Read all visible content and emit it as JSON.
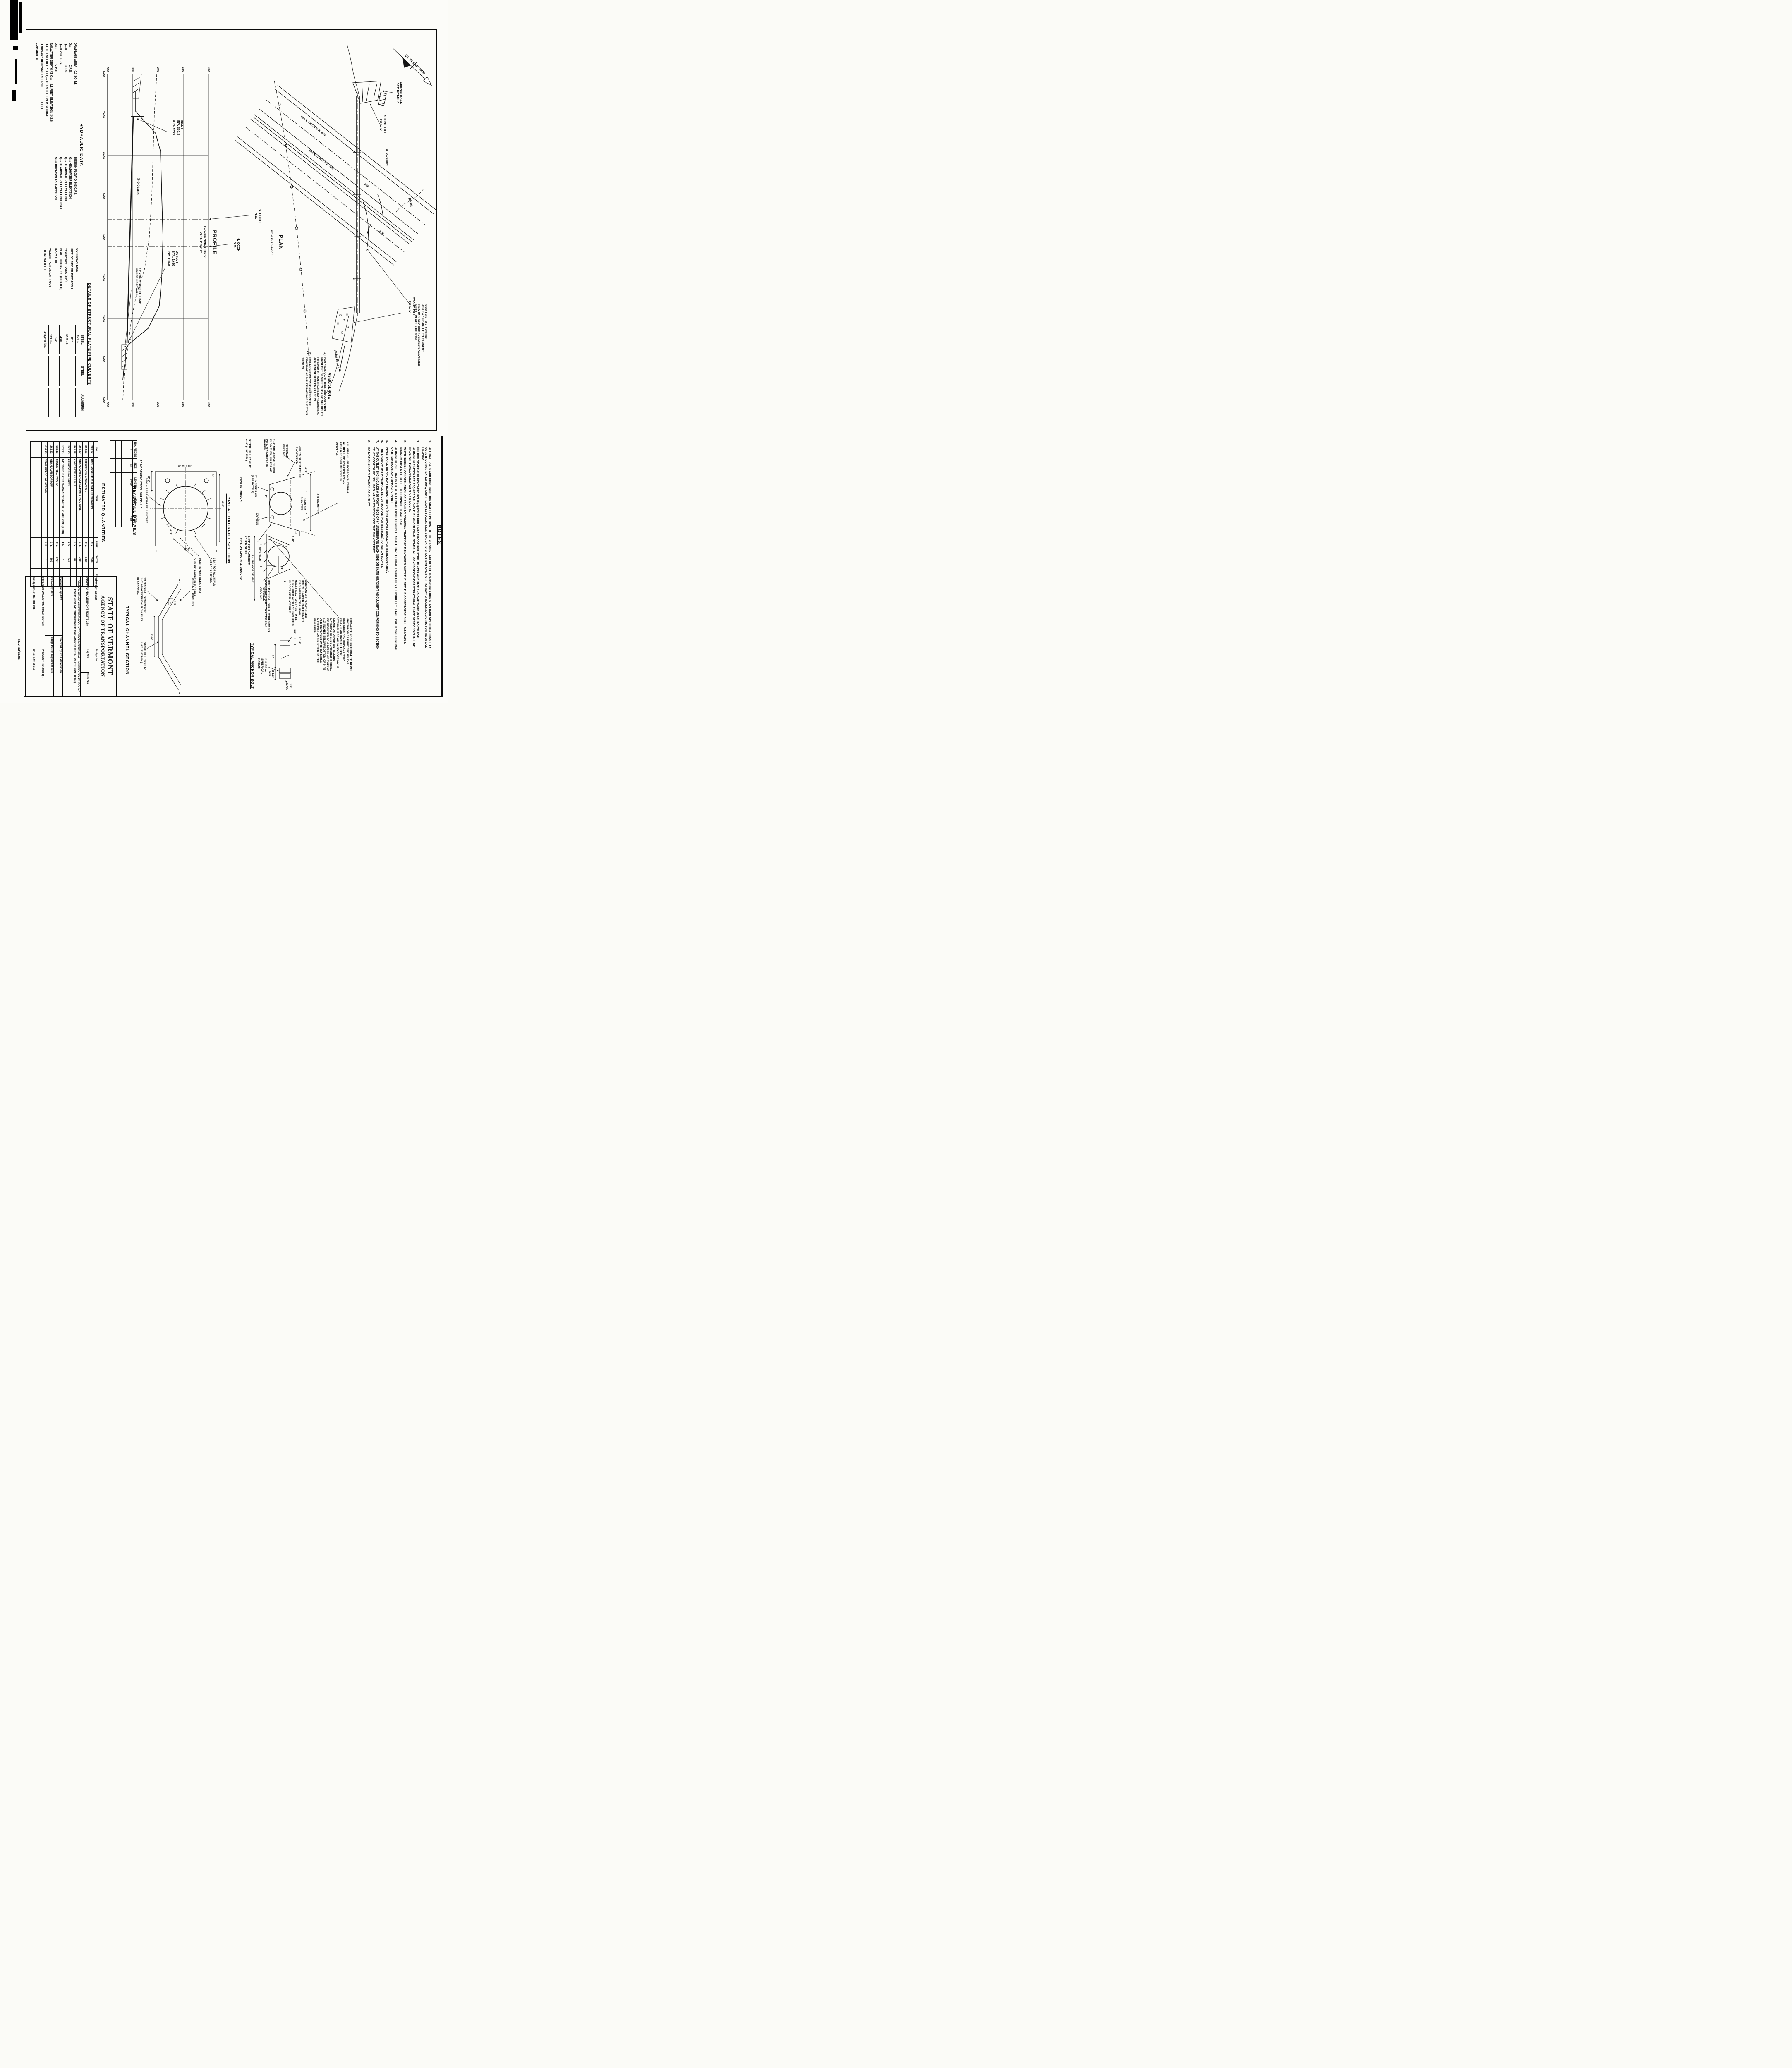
{
  "plan": {
    "title": "PLAN",
    "scale": "SCALE: 1\"=50'-0\"",
    "north_label": "VT. PLANE GRID",
    "debris_rack": "DEBRIS RACK\nSEE DETAILS",
    "stone_fill_inlet": "STONE FILL\nTYPE IV",
    "stone_fill_outlet": "STONE FILL\nTYPE IV",
    "cl_nb_line": "604    ℄ CCCH N.B.    605",
    "cl_sb_line": "604    ℄ CCCH S.B.    605",
    "ramp_a": "606",
    "ramp_b": "606",
    "slope": "S=0.0085%",
    "brook_upstream": "Brook",
    "brook_downstream": "Alder Brook",
    "sta_ticks": [
      "6",
      "5",
      "4",
      "3",
      "2"
    ],
    "pipe_note": "CCCH S.B. 605+93=3+80\nASKEW 128°-00' LT. TO TANGENT\nNEW 84\"x 565' CORRUGATED GALVANIZED\nMETAL PLATE PIPE 0.168",
    "as_built": {
      "title": "AS BUILT NOTE",
      "notes": [
        {
          "n": "1.)",
          "t": "FOR FINAL QUANTITIES SEE COMPUTER PRINT OUT OF SHEETS FOR 84\" MULTIPLATE PIPE AND 84\" MULTIPLATE SUPPLEMENTAL AGREEMENT SECTION 20 AND 21."
        },
        {
          "n": "2.)",
          "t": "FOR ADDITIONAL INFORMATION SEE DRAINAGE AS BUILT DRAWINGS SHEETS 21 THRU 23."
        }
      ]
    }
  },
  "profile": {
    "title": "PROFILE",
    "scales": "SCALES: HOR. 1\"=50'-0\"\nVERT. 1\"=10'-0\"",
    "stations": [
      "8+00",
      "7+00",
      "6+00",
      "5+00",
      "4+00",
      "3+00",
      "2+00",
      "1+00",
      "0+00"
    ],
    "elevations": [
      "410",
      "390",
      "370",
      "350",
      "330"
    ],
    "inlet_label": "INLET\nINV. 350.3\nSTA. 6+95",
    "outlet_label": "OUTLET\nSTA. 1+30\nINV. 345.5",
    "slope": "S=0.0085%",
    "stone_pad": "10' x 36' STONE FILL PAD\nUNDER HEADWALL",
    "cl_nb": "℄ CCCH\nN.B.",
    "cl_sb": "℄ CCCH\nS.B.",
    "data": {
      "pipe": {
        "inlet_station": "6+95",
        "inlet_invert": 350.3,
        "outlet_station": "1+30",
        "outlet_invert": 345.5,
        "slope": "0.0085%",
        "length_ft": 565,
        "diameter_in": 84
      },
      "elev_range": [
        330,
        410
      ],
      "station_range": [
        "0+00",
        "8+00"
      ]
    }
  },
  "hydraulic_data": {
    "title": "HYDRAULIC DATA",
    "rows": [
      {
        "l": "DRAINAGE AREA =  0.3  SQ. MI.",
        "r": "DESIGN FLOW Q 263 C.F.S."
      },
      {
        "l": "Q₁₀ = ________ C.F.S.",
        "r": "Q₁₀ HEADWATER ELEVATION = ______"
      },
      {
        "l": "Q₂₅ = ________ C.F.S.",
        "r": "Q₂₅ HEADWATER ELEVATION = ______"
      },
      {
        "l": "Q₅₀ =   263   C.F.S.",
        "r": "Q₅₀ HEADWATER ELEVATION =  358.1"
      },
      {
        "l": "Q₁₀₀ = _______ C.F.S.",
        "r": "Q₁₀₀ HEADWATER ELEVATION = _____"
      },
      {
        "l": "TAILWATER DEPTH AT Q₅₀ =  3.1  FEET, ELEVATION  342.6",
        "r": ""
      },
      {
        "l": "OUTLET VELOCITY AT Q₅₀ =  11.9  FEET PER SECOND",
        "r": ""
      },
      {
        "l": "ORDINARY HIGHWATER DEPTH ________ FEET",
        "r": ""
      },
      {
        "l": "COMMENTS: ____________________",
        "r": ""
      }
    ]
  },
  "details": {
    "title": "DETAILS OF STRUCTURAL PLATE PIPE CULVERTS",
    "columns": [
      "STEEL",
      "STEEL",
      "ALUMINUM"
    ],
    "rows": [
      {
        "label": "CORRUGATIONS",
        "v1": "3x1 in.",
        "v2": "",
        "v3": ""
      },
      {
        "label": "SIZE OF PIPE OR PIPE ARCH",
        "v1": "84\"",
        "v2": "",
        "v3": ""
      },
      {
        "label": "WATERWAY AREA (S.F.)",
        "v1": "38.5 s.f.",
        "v2": "",
        "v3": ""
      },
      {
        "label": "PLATE THICKNESS (COATED)",
        "v1": ".168\"",
        "v2": "",
        "v3": ""
      },
      {
        "label": "BOLT SIZE",
        "v1": "3/4\"",
        "v2": "",
        "v3": ""
      },
      {
        "label": "WEIGHT PER LINEAR FOOT",
        "v1": "253 lbs.",
        "v2": "",
        "v3": ""
      },
      {
        "label": "TOTAL WEIGHT",
        "v1": "142,945 lbs.",
        "v2": "",
        "v3": ""
      }
    ]
  },
  "notes": {
    "title": "NOTES",
    "items": [
      {
        "n": "1.",
        "t": "ALL MATERIALS AND CONSTRUCTION SHALL CONFORM TO THE VERMONT AGENCY OF TRANSPORTATION STANDARD SPECIFICATIONS FOR CONSTRUCTION DATED 1990, AND THE LATEST A.A.S.H.T.O. STANDARD SPECIFICATIONS FOR HIGHWAY BRIDGES.  DESIGN IS FOR HS-20 LIVE LOADING."
      },
      {
        "n": "2.",
        "t": "UNLESS OTHERWISE INDICATED FOUR (4) BOLTS PER LINEAR FOOT FOR STEEL PLATES AND FIVE AND ONE THIRD (5 1/3) BOLTS FOR ALUMINUM PLATES ARE REQUIRED ALONG THE LONGITUDINAL SEAMS. ALL CONNECTIONS FOR STRUCTURAL PLATE SECTIONS SHALL BE MADE WITH GALVANIZED ASTM A-449 BOLTS."
      },
      {
        "n": "3.",
        "t": "WHEN NORMAL CONSTRUCTION OR REGULAR ROADWAY TRAFFIC IS MAINTAINED OVER THE PIPE THE CONTRACTOR SHALL MAINTAIN A MINIMUM COVER OF 3 FEET OF COMPACTED MATERIAL."
      },
      {
        "n": "4.",
        "t": "ALUMINUM PIPE THAT IS TO BE IN CONTACT WITH CONCRETE SHALL HAVE CONTACT SURFACES THOROUGHLY COATED WITH ZINC CHROMATE, OR BITUMINOUS, OR ASPHALTIC PAINT."
      },
      {
        "n": "5.",
        "t": "PIPES SHALL BE FACTORY ELONGATED 5% (PIPE ARCHES SHALL NOT BE ELONGATED)."
      },
      {
        "n": "6.",
        "t": "THE ENDS OF THE PIPE SHALL BE CUT SQUARE (NOT BEVELED) TO MATCH SLOPES."
      },
      {
        "n": "7.",
        "t": "AT THE OUTLET END INCLUDE A 10 FOOT PIECE OF 6\" UNDERDRAIN EACH SIDE ON SAME GRADIENT AS CULVERT CONFORMING TO SECTION 711.07. COST TO BE INCLUDED IN UNIT PRICE BID FOR THE CULVERT PIPE."
      },
      {
        "n": "8.",
        "t": "DO NOT CHANGE ELEVATION OF OUTLET."
      }
    ]
  },
  "granular_note": "ALL GRANULAR BORROW MATERIAL\nWITHIN 4' OF THE PIPE SHALL\nPASS A 3\" SQUARE SCREEN\nOPENING.",
  "excavate_note": "EXCAVATE POOR MATERIAL TO DEPTH SHOWN OR AS DIRECTED BY THE ENGINEER AND REPLACE WITH GRANULAR BACKFILL FOR STRUCTURES OR SAND BORROW. IF LEDGE OR OTHER UNYIELDING MATERIAL IS ENCOUNTERED IT SHALL BE REMOVED TO A DEPTH OF TWELVE (12) INCHES BELOW BOTTOM OF PIPE AND REPLACED WITH SUITABLE MATERIAL AS DIRECTED BY THE ENGINEER.",
  "backfill": {
    "title": "TYPICAL BACKFILL SECTION",
    "labels": {
      "four_x_diameter": "4 X DIAMETER",
      "span_or_diameter": "SPAN OR\nDIAMETER",
      "dim_1_6": "1'-6\"",
      "original_ground": "ORIGINAL\nGROUND",
      "original_ground2": "ORIGINAL\nGROUND",
      "limits": "LIMITS OF STRUCTURE\nEXCAVATION",
      "slope_2_1": "2:1",
      "three_span": "3 x SPAN OR 25' MAX.",
      "pipe_in_trench": "PIPE IN TRENCH",
      "pipe_on_ground": "PIPE ON ORIGINAL GROUND",
      "min_above": "2'-0\" MIN. ABOVE DESIGN\nFLOW ELEV., OR TOP OF\nPIPE, WHICHEVER IS\nHIGHER.",
      "underdrain": "6\" UNDERDRAIN\n(SEE NOTE 7)",
      "cap_end": "CAP END",
      "alum_steel": "1 3/4\" FOR ALUMINUM\n2\" FOR STEEL",
      "stone_fill": "STONE FILL, TYPE IV\n4'-0\" (2'-0\" MIN.)",
      "dim_1_0": "1'-0\"",
      "dim_3": "3\"",
      "dim_4": "4'",
      "half_span": "1/2 x SPAN"
    }
  },
  "headwall": {
    "title": "HEADWALL DETAILS",
    "labels": {
      "dim_8_6": "8'-6\"",
      "dim_6": "6\"",
      "clear": "6\" CLEAR",
      "dim_1_6": "1'-6\"",
      "dim_2_0": "2'-0\"",
      "dim_4_6": "4'-6\"",
      "bars": "3-NO.6 BARS AT INLET & OUTLET",
      "alum": "1 3/4\" FOR ALUMINUM\nAND 2\" FOR STEEL",
      "inlet_inv": "INLET INVERT ELEV. 350.3",
      "outlet_inv": "OUTLET INVERT ELEV. 345.5"
    }
  },
  "reinforcing": {
    "title": "REINFORCING STEEL SCHEDULE",
    "headers": [
      "NO. PIECES",
      "SIZE",
      "LENGTH",
      "MARK",
      "TYPE"
    ],
    "rows": [
      [
        "6",
        "#6",
        "27'-0\"",
        "",
        "STR."
      ],
      [
        "",
        "",
        "",
        "",
        ""
      ],
      [
        "",
        "",
        "",
        "",
        ""
      ],
      [
        "",
        "",
        "",
        "",
        ""
      ]
    ]
  },
  "quantities": {
    "title": "ESTIMATED QUANTITIES",
    "headers": [
      "NO.",
      "ITEM",
      "UNIT",
      "TOTAL",
      "FINAL"
    ],
    "rows": [
      [
        "203.27",
        "UNCLASSIFIED CHANNEL EXCAVATION",
        "C.Y.",
        "1540",
        ""
      ],
      [
        "204.25",
        "STRUCTURE EXCAVATION",
        "C.Y.",
        "1499",
        ""
      ],
      [
        "204.30",
        "GRANULAR BACKFILL FOR STRUCTURE",
        "C.Y.",
        "1464",
        ""
      ],
      [
        "501.25",
        "CONCRETE, CLASS B",
        "C.Y.",
        "53",
        ""
      ],
      [
        "507.15",
        "REINFORCING STEEL",
        "LB.",
        "243",
        ""
      ],
      [
        "511.15",
        "84\" CORRUGATED GALVANIZED METAL PLATE PIPE (0.168)",
        "EA.",
        "1",
        ""
      ],
      [
        "613.13",
        "STONE FILL, TYPE IV",
        "C.Y.",
        "1707",
        ""
      ],
      [
        "203.32",
        "GRANULAR BORROW",
        "C.Y.",
        "800",
        ""
      ],
      [
        "614.10",
        "TEMP. RELOC. OF STREAM",
        "L.S.",
        "1",
        ""
      ],
      [
        "",
        "",
        "",
        "",
        ""
      ],
      [
        "",
        "",
        "",
        "",
        ""
      ]
    ]
  },
  "anchor_bolt": {
    "title": "TYPICAL ANCHOR BOLT",
    "one_row_note": "ONE ROW 3/4\" GALVANIZED\nBOLTS, SPACED IN ALTERNATE\nCIRCUMFERENTIAL SEAM\nHOLES (19.2\" O/C) AND TO BE\nFURNISHED WITH AND INCLUDED\nIN COST OF PLATE PIPE.",
    "material_note": "BOLT MATERIAL SHALL CONFORM TO\nASTM-A307 & NUTS TO ASTM-A563.",
    "dims": {
      "d1": "1 1/4\"",
      "d2": "3/4\"",
      "d3": "6\"",
      "d4": "2 1/2\"\nMIN.",
      "d5": "1/8\"\nMAX.",
      "nuts": "2 NUTS W/\nSPHERICAL\nRADIUS"
    }
  },
  "channel": {
    "title": "TYPICAL CHANNEL SECTION",
    "labels": {
      "original_ground": "ORIGINAL GROUND",
      "dim_4_0": "4'-0\"",
      "slope": "1.5\n1",
      "to_original": "TO ORIGINAL GROUND OR\n1'-0\" ABOVE DESIGN FLOW ELEV.\nIN CHANNEL.",
      "stone_fill": "STONE FILL, TYPE IV\n4'-0\" (2'-0\" MIN.)"
    }
  },
  "title_block": {
    "agency1": "STATE OF VERMONT",
    "agency2": "AGENCY OF TRANSPORTATION",
    "town": "TOWN OF      ESSEX",
    "bridge_no": "Bridge No.",
    "highway": "HIGHWAY NO. VERMONT ROUTE 289",
    "log_sta": "Log Sta.",
    "surv_sta": "Surv. Sta.",
    "description": "STATION 605+93 CHITTENDEN COUNTY CIRCUMFERENTIAL HIGHWAY SOUTHBOUND OVER NEW 84\" CORRUGATED GALVANIZED METAL PLATE PIPE (0.168)",
    "designed": "Designed by  JRC",
    "checked": "Checked by  RCA    date 5/6/87",
    "drawn": "Drawn by  JFD",
    "supervisor": "Bridge Design Supervisor    date",
    "project": "PROJECT   WILLISTON-COLCHESTER",
    "project_no": "PROJECT NO.  033-1( )",
    "bridge_sheet": "Bridge Sheet No.   BR 101",
    "sheet": "Sheet  140  of  310"
  },
  "rev_note": "REV. 12/11/85"
}
